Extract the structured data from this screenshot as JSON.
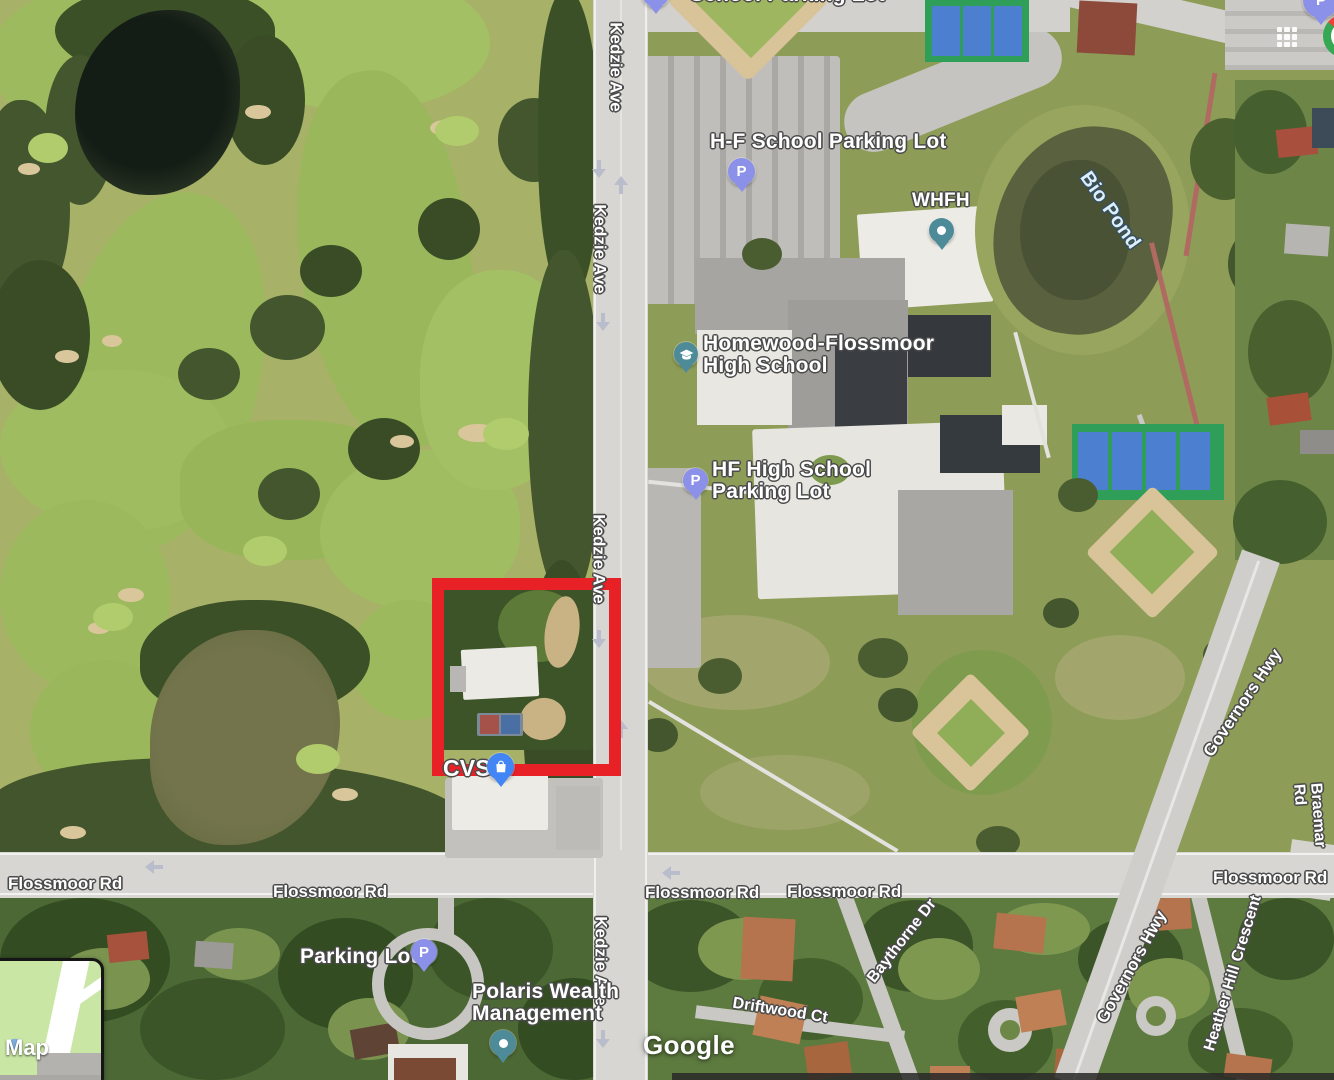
{
  "watermark": "Google",
  "map_toggle": {
    "label": "Map"
  },
  "highlight": {
    "style": "border-color:#e82127",
    "color": "#e82127"
  },
  "place_labels": {
    "top_edge": "School Parking Lot",
    "hf_school_parking_lot": "H-F School Parking Lot",
    "whfh": "WHFH",
    "hf_high_school": "Homewood-Flossmoor\nHigh School",
    "hf_high_school_parking_lot": "HF High School\nParking Lot",
    "bio_pond": "Bio Pond",
    "cvs": "CVS",
    "parking_lot": "Parking Lot",
    "polaris_wealth": "Polaris Wealth\nManagement"
  },
  "road_labels": {
    "kedzie_ave": "Kedzie Ave",
    "flossmoor_rd": "Flossmoor Rd",
    "governors_hwy": "Governors Hwy",
    "braemar_rd": "Braemar Rd",
    "heather_hill_crescent": "Heather Hill Crescent",
    "baythorne_dr": "Baythorne Dr",
    "driftwood_ct": "Driftwood Ct"
  },
  "pins": {
    "parking_color": "#8b90e8",
    "place_color": "#4e8b99",
    "shopping_color": "#4285f4"
  }
}
